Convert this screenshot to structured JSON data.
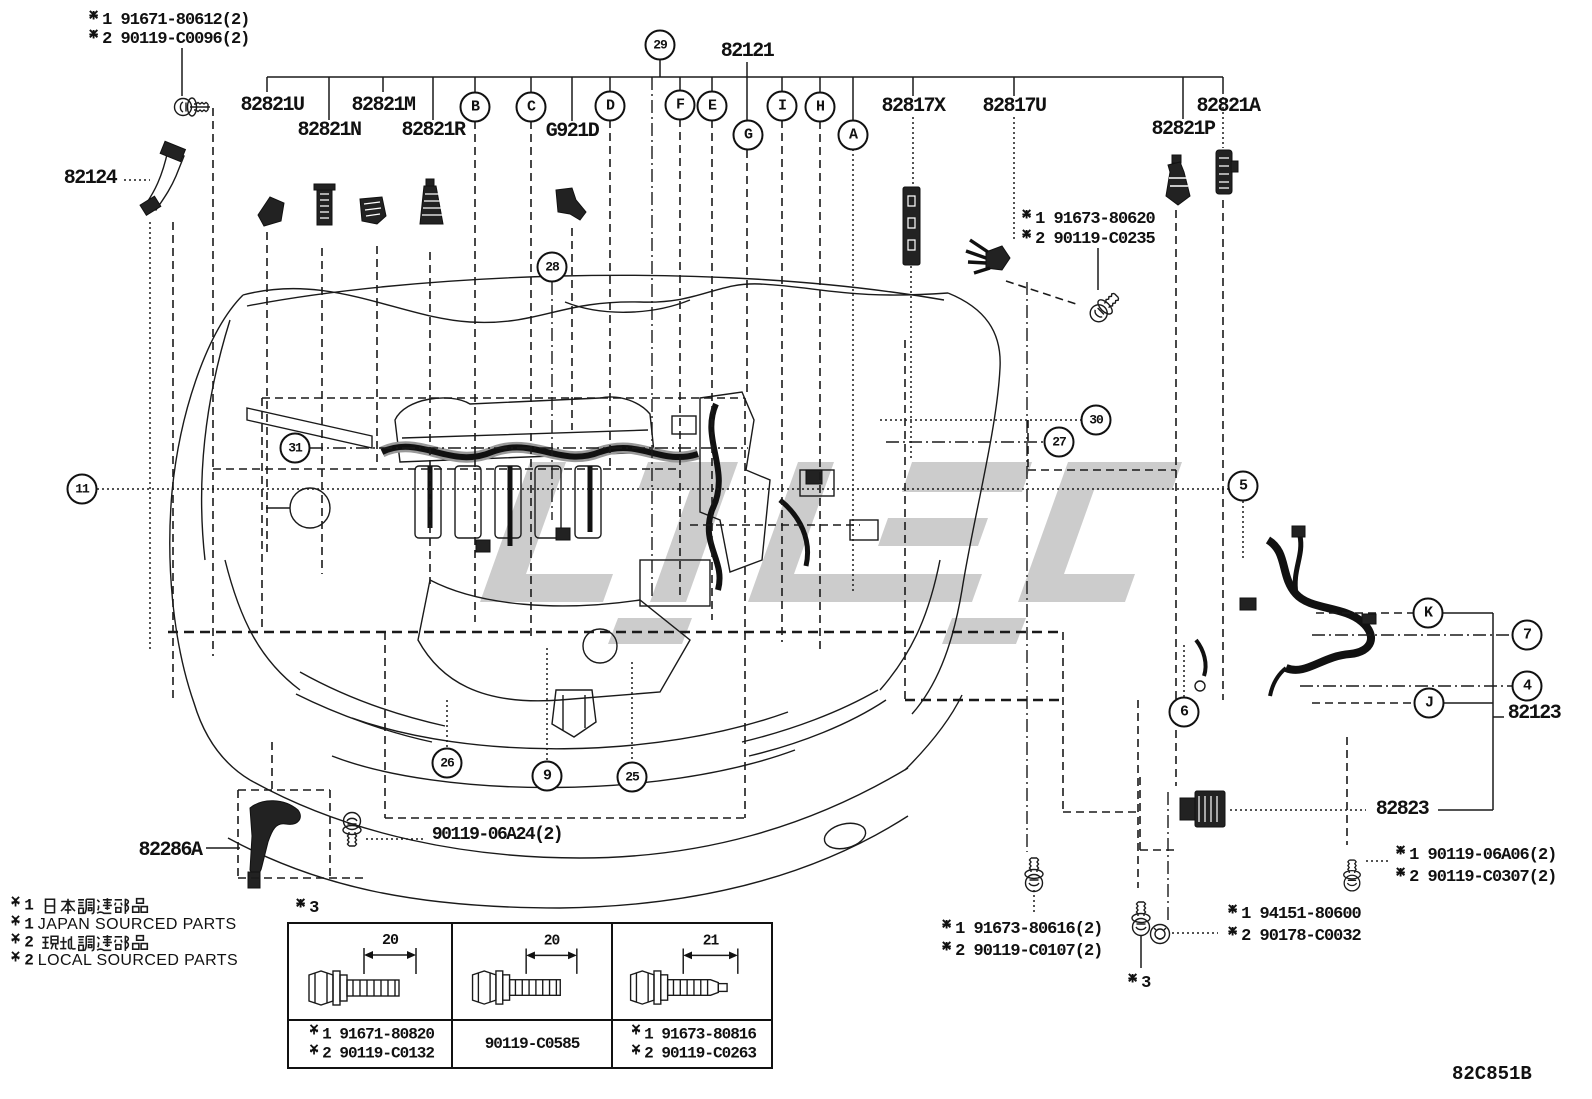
{
  "colors": {
    "ink": "#1a1a1a",
    "part_fill": "#222222",
    "watermark": "#c7c7c7",
    "background": "#ffffff"
  },
  "drawing_code": "82C851B",
  "labels": {
    "p82124": "82124",
    "p82821U": "82821U",
    "p82821N": "82821N",
    "p82821M": "82821M",
    "p82821R": "82821R",
    "pG921D": "G921D",
    "p82121": "82121",
    "p82817X": "82817X",
    "p82817U": "82817U",
    "p82821P": "82821P",
    "p82821A": "82821A",
    "p82123": "82123",
    "p82823": "82823",
    "p82286A": "82286A",
    "p90119_06A24": "90119-06A24(2)"
  },
  "notes": {
    "tl1": "※1 91671-80612(2)",
    "tl2": "※2 90119-C0096(2)",
    "r1": "※1 91673-80620",
    "r2": "※2 90119-C0235",
    "a1": "※1 90119-06A06(2)",
    "a2": "※2 90119-C0307(2)",
    "b1": "※1 94151-80600",
    "b2": "※2 90178-C0032",
    "c1": "※1 91673-80616(2)",
    "c2": "※2 90119-C0107(2)",
    "n3": "※3"
  },
  "legend": {
    "items": [
      {
        "mark": "※1",
        "jp": "日本調達部品"
      },
      {
        "mark": "※1",
        "en": "JAPAN SOURCED PARTS"
      },
      {
        "mark": "※2",
        "jp": "現地調達部品"
      },
      {
        "mark": "※2",
        "en": "LOCAL SOURCED PARTS"
      }
    ]
  },
  "bolt_table": {
    "mark": "※3",
    "cols": [
      {
        "dim": "20",
        "lines": [
          "※1 91671-80820",
          "※2 90119-C0132"
        ]
      },
      {
        "dim": "20",
        "lines": [
          "90119-C0585"
        ]
      },
      {
        "dim": "21",
        "lines": [
          "※1 91673-80816",
          "※2 90119-C0263"
        ]
      }
    ]
  },
  "callouts": {
    "A": "A",
    "B": "B",
    "C": "C",
    "D": "D",
    "E": "E",
    "F": "F",
    "G": "G",
    "H": "H",
    "I": "I",
    "J": "J",
    "K": "K",
    "n4": "4",
    "n5": "5",
    "n6": "6",
    "n7": "7",
    "n9": "9",
    "n11": "11",
    "n25": "25",
    "n26": "26",
    "n27": "27",
    "n28": "28",
    "n29": "29",
    "n30": "30",
    "n31": "31"
  }
}
